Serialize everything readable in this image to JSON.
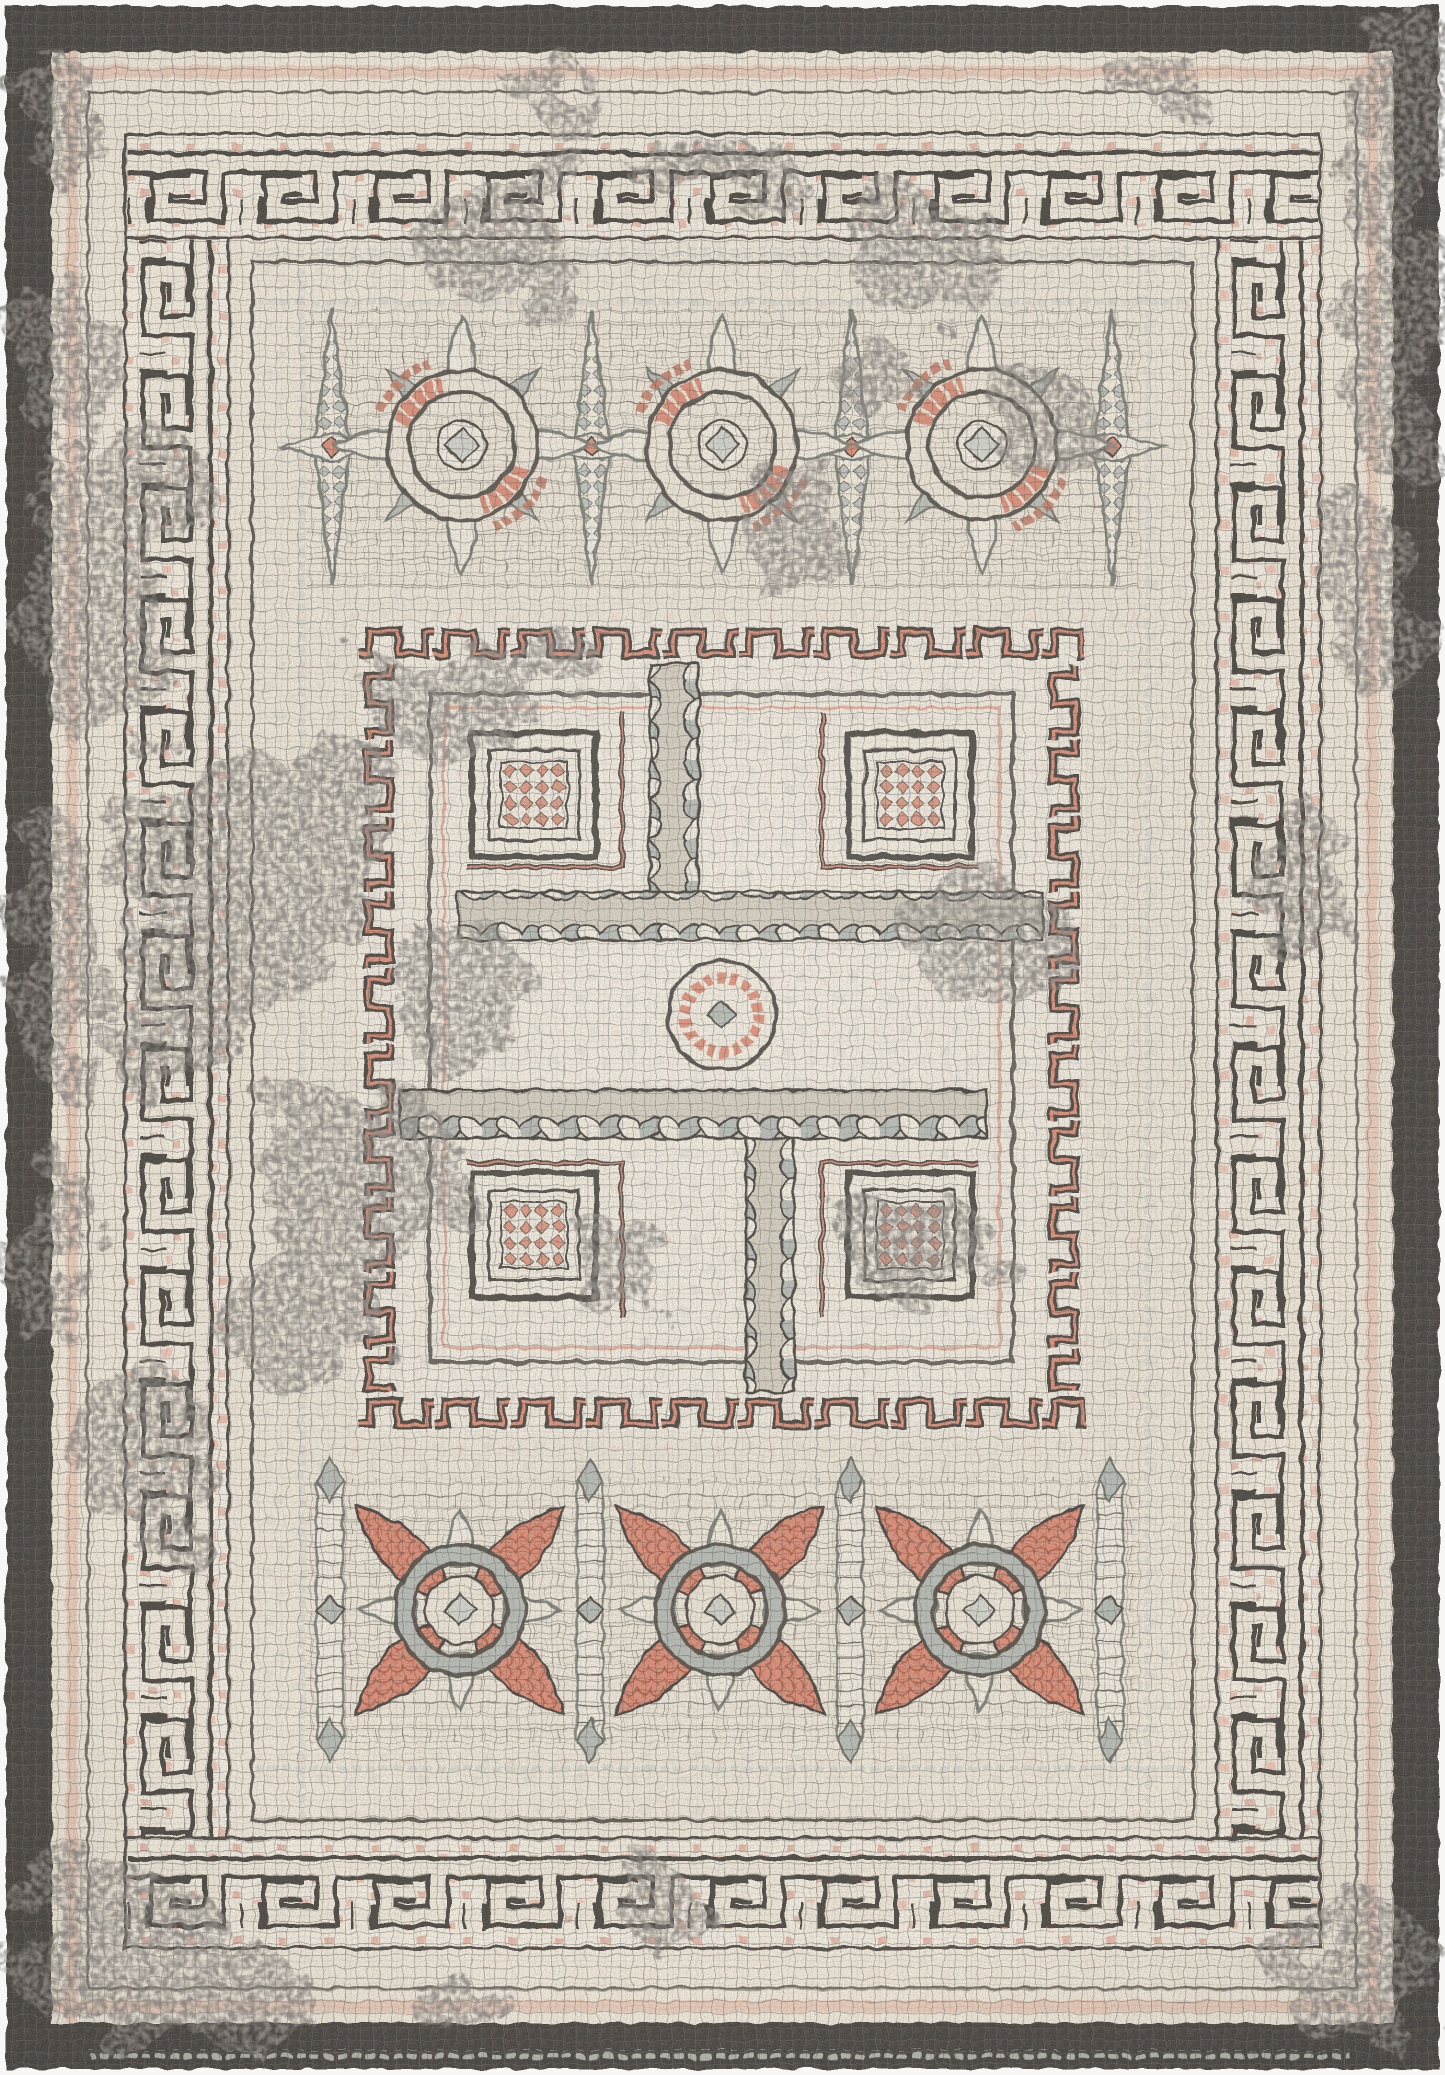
{
  "meta": {
    "title": "Product photo: distressed Roman mosaic style area rug with Greek key border, rosette bands and crenellated labyrinth medallion",
    "image_width": 1445,
    "image_height": 2075
  },
  "palette": {
    "photo_background": "#f8f7f5",
    "cream": "#f2ebdd",
    "cream_light": "#f6f0e4",
    "cream_shadow": "#e7dfcd",
    "grout": "#524e48",
    "charcoal": "#474340",
    "salmon": "#e2937c",
    "salmon_light": "#efb19c",
    "rust": "#c87e66",
    "gray_tile": "#bcc1bb",
    "gray_light": "#d8dad3",
    "outline_gray": "#84877f"
  },
  "rug": {
    "style": "flat-woven mosaic tessera look, heavily distressed",
    "border": {
      "outer_band": "charcoal tile band around entire rug",
      "greek_key_band": "cream meander path edged in charcoal over salmon-speckled ground",
      "inner_frame": "thin charcoal double frame with gray dotted tile rows"
    },
    "top_band": {
      "motif": "ring rosettes with salmon crescent arcs, star-lily separators",
      "rosette_cy": 445,
      "rosettes": [
        {
          "cx": 462,
          "cy": 445
        },
        {
          "cx": 722,
          "cy": 445
        },
        {
          "cx": 982,
          "cy": 445
        }
      ],
      "separator_cy": 447,
      "separators": [
        {
          "cx": 332
        },
        {
          "cx": 592
        },
        {
          "cx": 852
        },
        {
          "cx": 1112
        }
      ]
    },
    "medallion": {
      "motif": "crenellated square panel, guilloche pinwheel labyrinth, four framed squares with salmon diamond lattice, central circle medallion",
      "x": 358,
      "y": 622,
      "width": 727,
      "height": 812,
      "corner_squares": [
        {
          "cx": 534,
          "cy": 795
        },
        {
          "cx": 910,
          "cy": 795
        },
        {
          "cx": 534,
          "cy": 1235
        },
        {
          "cx": 910,
          "cy": 1235
        }
      ],
      "center_circle": {
        "cx": 722,
        "cy": 1015,
        "r": 54
      }
    },
    "bottom_band": {
      "motif": "quatrefoil rosettes with salmon shell petals, ladder separators",
      "rosette_cy": 1610,
      "rosettes": [
        {
          "cx": 460,
          "cy": 1610
        },
        {
          "cx": 720,
          "cy": 1610
        },
        {
          "cx": 980,
          "cy": 1610
        }
      ],
      "separator_cy": 1610,
      "separators": [
        {
          "cx": 330
        },
        {
          "cx": 590
        },
        {
          "cx": 850
        },
        {
          "cx": 1110
        }
      ]
    },
    "distress_patches": [
      {
        "cx": 490,
        "cy": 250,
        "rx": 90,
        "ry": 55,
        "rot": 15
      },
      {
        "cx": 555,
        "cy": 180,
        "rx": 35,
        "ry": 45,
        "rot": 0
      },
      {
        "cx": 740,
        "cy": 168,
        "rx": 62,
        "ry": 20,
        "rot": 0
      },
      {
        "cx": 560,
        "cy": 95,
        "rx": 45,
        "ry": 26,
        "rot": 0
      },
      {
        "cx": 645,
        "cy": 158,
        "rx": 30,
        "ry": 22,
        "rot": 0
      },
      {
        "cx": 1160,
        "cy": 85,
        "rx": 55,
        "ry": 26,
        "rot": 0
      },
      {
        "cx": 930,
        "cy": 255,
        "rx": 80,
        "ry": 68,
        "rot": 0
      },
      {
        "cx": 1042,
        "cy": 425,
        "rx": 55,
        "ry": 58,
        "rot": 0
      },
      {
        "cx": 878,
        "cy": 378,
        "rx": 34,
        "ry": 40,
        "rot": 0
      },
      {
        "cx": 1418,
        "cy": 95,
        "rx": 60,
        "ry": 85,
        "rot": 0
      },
      {
        "cx": 1390,
        "cy": 310,
        "rx": 55,
        "ry": 170,
        "rot": 0
      },
      {
        "cx": 1372,
        "cy": 600,
        "rx": 48,
        "ry": 95,
        "rot": 0
      },
      {
        "cx": 1296,
        "cy": 880,
        "rx": 48,
        "ry": 88,
        "rot": 0
      },
      {
        "cx": 795,
        "cy": 528,
        "rx": 42,
        "ry": 92,
        "rot": 0
      },
      {
        "cx": 62,
        "cy": 118,
        "rx": 50,
        "ry": 60,
        "rot": 0
      },
      {
        "cx": 60,
        "cy": 355,
        "rx": 40,
        "ry": 95,
        "rot": 0
      },
      {
        "cx": 95,
        "cy": 600,
        "rx": 70,
        "ry": 150,
        "rot": 0
      },
      {
        "cx": 152,
        "cy": 480,
        "rx": 50,
        "ry": 58,
        "rot": 0
      },
      {
        "cx": 55,
        "cy": 950,
        "rx": 45,
        "ry": 140,
        "rot": 0
      },
      {
        "cx": 48,
        "cy": 1250,
        "rx": 40,
        "ry": 110,
        "rot": 0
      },
      {
        "cx": 238,
        "cy": 878,
        "rx": 115,
        "ry": 135,
        "rot": 10
      },
      {
        "cx": 332,
        "cy": 788,
        "rx": 68,
        "ry": 58,
        "rot": 0
      },
      {
        "cx": 172,
        "cy": 1032,
        "rx": 68,
        "ry": 78,
        "rot": 0
      },
      {
        "cx": 452,
        "cy": 700,
        "rx": 88,
        "ry": 52,
        "rot": 0
      },
      {
        "cx": 548,
        "cy": 660,
        "rx": 48,
        "ry": 38,
        "rot": 0
      },
      {
        "cx": 465,
        "cy": 1002,
        "rx": 66,
        "ry": 88,
        "rot": 0
      },
      {
        "cx": 362,
        "cy": 1180,
        "rx": 105,
        "ry": 105,
        "rot": 0
      },
      {
        "cx": 300,
        "cy": 1320,
        "rx": 78,
        "ry": 68,
        "rot": 0
      },
      {
        "cx": 142,
        "cy": 1452,
        "rx": 68,
        "ry": 88,
        "rot": 0
      },
      {
        "cx": 118,
        "cy": 1950,
        "rx": 115,
        "ry": 88,
        "rot": 0
      },
      {
        "cx": 255,
        "cy": 2002,
        "rx": 70,
        "ry": 45,
        "rot": 0
      },
      {
        "cx": 617,
        "cy": 1262,
        "rx": 52,
        "ry": 58,
        "rot": 0
      },
      {
        "cx": 990,
        "cy": 938,
        "rx": 82,
        "ry": 66,
        "rot": 0
      },
      {
        "cx": 918,
        "cy": 1248,
        "rx": 78,
        "ry": 58,
        "rot": 0
      },
      {
        "cx": 662,
        "cy": 1912,
        "rx": 42,
        "ry": 36,
        "rot": 0
      },
      {
        "cx": 1362,
        "cy": 1978,
        "rx": 85,
        "ry": 75,
        "rot": 0
      },
      {
        "cx": 462,
        "cy": 2006,
        "rx": 52,
        "ry": 32,
        "rot": 0
      }
    ]
  }
}
